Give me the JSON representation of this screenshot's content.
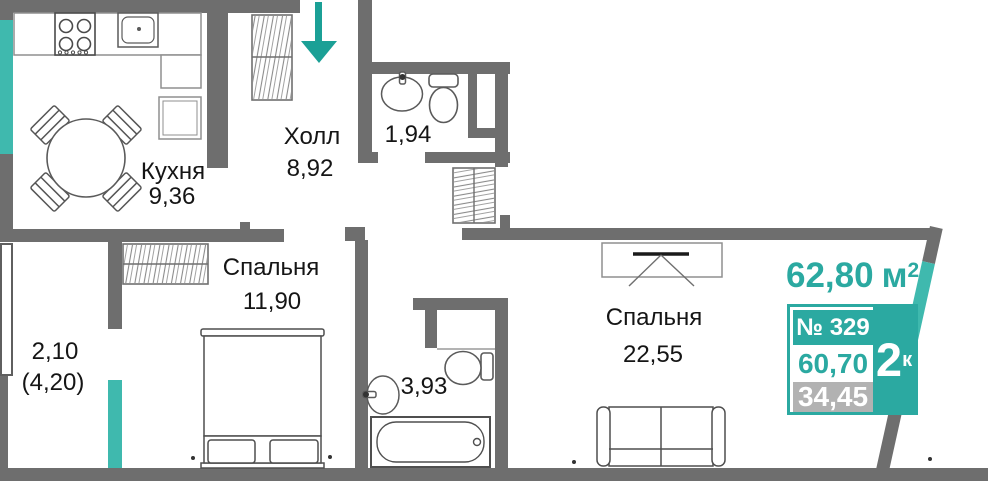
{
  "colors": {
    "wall": "#6E6E6E",
    "accent": "#2BA9A1",
    "window": "#3FB9AE",
    "arrow": "#1BA096",
    "panel_gray": "#B2B2B2"
  },
  "rooms": {
    "hall": {
      "label": "Холл",
      "area": "8,92"
    },
    "kitchen": {
      "label": "Кухня",
      "area": "9,36"
    },
    "wc": {
      "area": "1,94"
    },
    "bedroom_small": {
      "label": "Спальня",
      "area": "11,90"
    },
    "bathroom": {
      "area": "3,93"
    },
    "bedroom_large": {
      "label": "Спальня",
      "area": "22,55"
    },
    "balcony": {
      "area_coefficient": "2,10",
      "area_full": "(4,20)"
    }
  },
  "panel": {
    "total_area": "62,80",
    "total_area_unit": "м",
    "total_area_sup": "2",
    "apartment_number": "№ 329",
    "rooms_count": "2",
    "rooms_count_sup": "к",
    "living_area": "60,70",
    "additional_area": "34,45"
  },
  "icons": {
    "entrance": "arrow-down"
  }
}
